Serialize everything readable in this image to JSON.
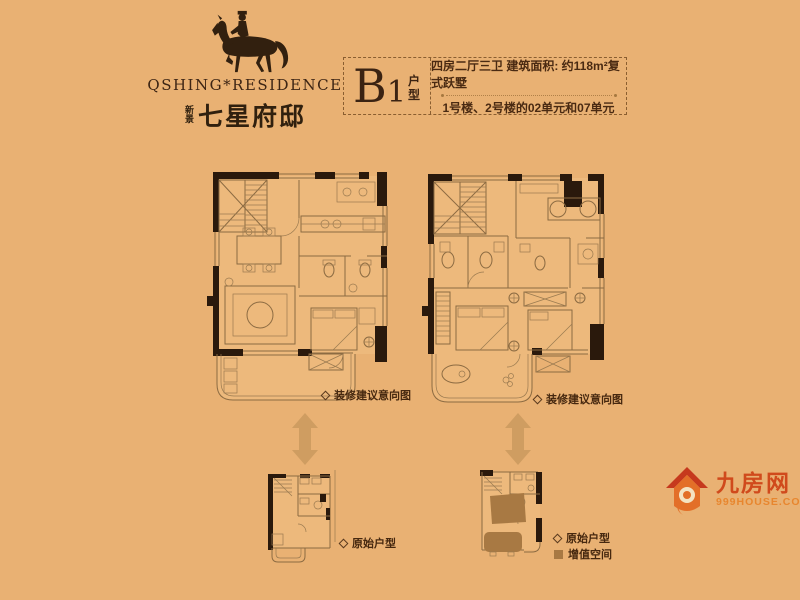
{
  "logo": {
    "icon": "horse-rider-icon",
    "brand_en": "QSHING*RESIDENCE",
    "brand_cn_prefix": "新景",
    "brand_cn": "七星府邸"
  },
  "header": {
    "unit_code": "B1",
    "unit_type_label": "户型",
    "spec_line": "四房二厅三卫  建筑面积: 约118m²复式跃墅",
    "building_line": "1号楼、2号楼的02单元和07单元"
  },
  "plan_labels": {
    "suggested_left": "装修建议意向图",
    "suggested_right": "装修建议意向图",
    "original_left": "原始户型",
    "original_right": "原始户型",
    "value_space": "增值空间"
  },
  "icons": {
    "double_arrow": "double-arrow-icon",
    "diamond_bullet": "diamond-bullet-icon",
    "value_swatch": "value-space-swatch",
    "house": "house-icon"
  },
  "watermark": {
    "site_name": "九房网",
    "site_url": "999HOUSE.COM"
  },
  "colors": {
    "background": "#e9b173",
    "wall": "#2a190c",
    "plan_line": "#8c6b42",
    "text": "#46280f",
    "value_space_fill": "#a87943",
    "arrow": "#cf9d61",
    "watermark_red": "#d04a1c",
    "watermark_orange": "#e8862e"
  }
}
